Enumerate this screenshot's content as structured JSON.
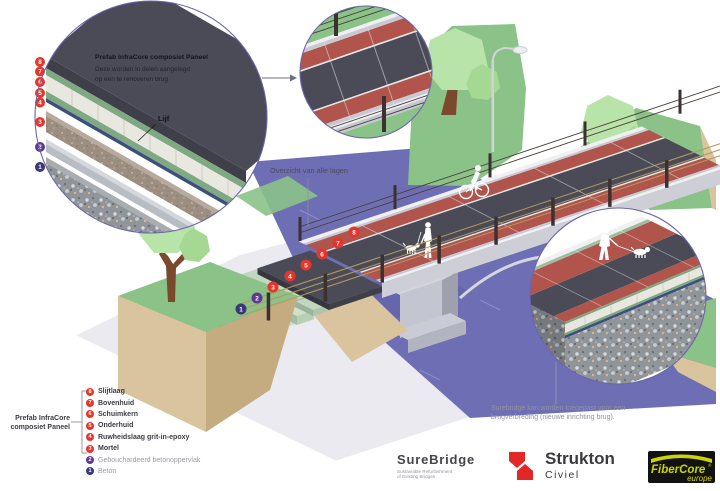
{
  "colors": {
    "water": "#6e6eb4",
    "grass": "#8ac288",
    "tree_light": "#b9e4a9",
    "tree_mid": "#a4d893",
    "trunk": "#7b4a2e",
    "earth": "#d9c49d",
    "earth_dark": "#c4ab80",
    "base": "#eaeaf0",
    "road": "#4b4b57",
    "bike_lane": "#b1544b",
    "deck_white": "#f0f0f3",
    "curb": "#c9c9d3",
    "pier": "#c3c6d0",
    "panel_cream": "#e9e8e0",
    "panel_green": "#7fa982",
    "foam_green": "#cfe0cb",
    "grit_blue": "#76839d",
    "mortar": "#a3968a",
    "concrete": "#90959a",
    "fence_post": "#3a3130",
    "fence_wire": "#b59a5f",
    "badge_red": "#e8352b",
    "badge_purple": "#5f3a94",
    "badge_indigo": "#3b3677",
    "circle_stroke": "#6b66ae",
    "text_dark": "#3c3c46",
    "text_gray": "#8f8f9a",
    "strukton_red": "#e32726",
    "fibercore_yellow": "#cdd500",
    "logo_black": "#121212"
  },
  "callout_panel": {
    "title": "Prefab InfraCore composiet Paneel",
    "desc1": "Deze worden in delen aangelegd",
    "desc2": "op een te renoveren brug",
    "web_label": "Lijf"
  },
  "scene": {
    "overview_label": "Overzicht van alle lagen",
    "widening_note1": "Surebridge kan worden toegepast voor een",
    "widening_note2": "brugverbreding (nieuwe inrichting brug)."
  },
  "legend": {
    "group_label1": "Prefab InfraCore",
    "group_label2": "composiet Paneel",
    "items": [
      {
        "n": "8",
        "label": "Slijtlaag"
      },
      {
        "n": "7",
        "label": "Bovenhuid"
      },
      {
        "n": "6",
        "label": "Schuimkern"
      },
      {
        "n": "5",
        "label": "Onderhuid"
      },
      {
        "n": "4",
        "label": "Ruwheidslaag grit-in-epoxy"
      },
      {
        "n": "3",
        "label": "Mortel"
      },
      {
        "n": "2",
        "label": "Gebouchardeerd betonoppervlak"
      },
      {
        "n": "1",
        "label": "Beton"
      }
    ]
  },
  "logos": {
    "surebridge": {
      "name": "SureBridge",
      "tagline1": "Sustainable Refurbishment",
      "tagline2": "of Existing Bridges"
    },
    "strukton": {
      "name": "Strukton",
      "division": "Civiel"
    },
    "fibercore": {
      "name": "FiberCore",
      "region": "europe",
      "reg": "®"
    }
  }
}
